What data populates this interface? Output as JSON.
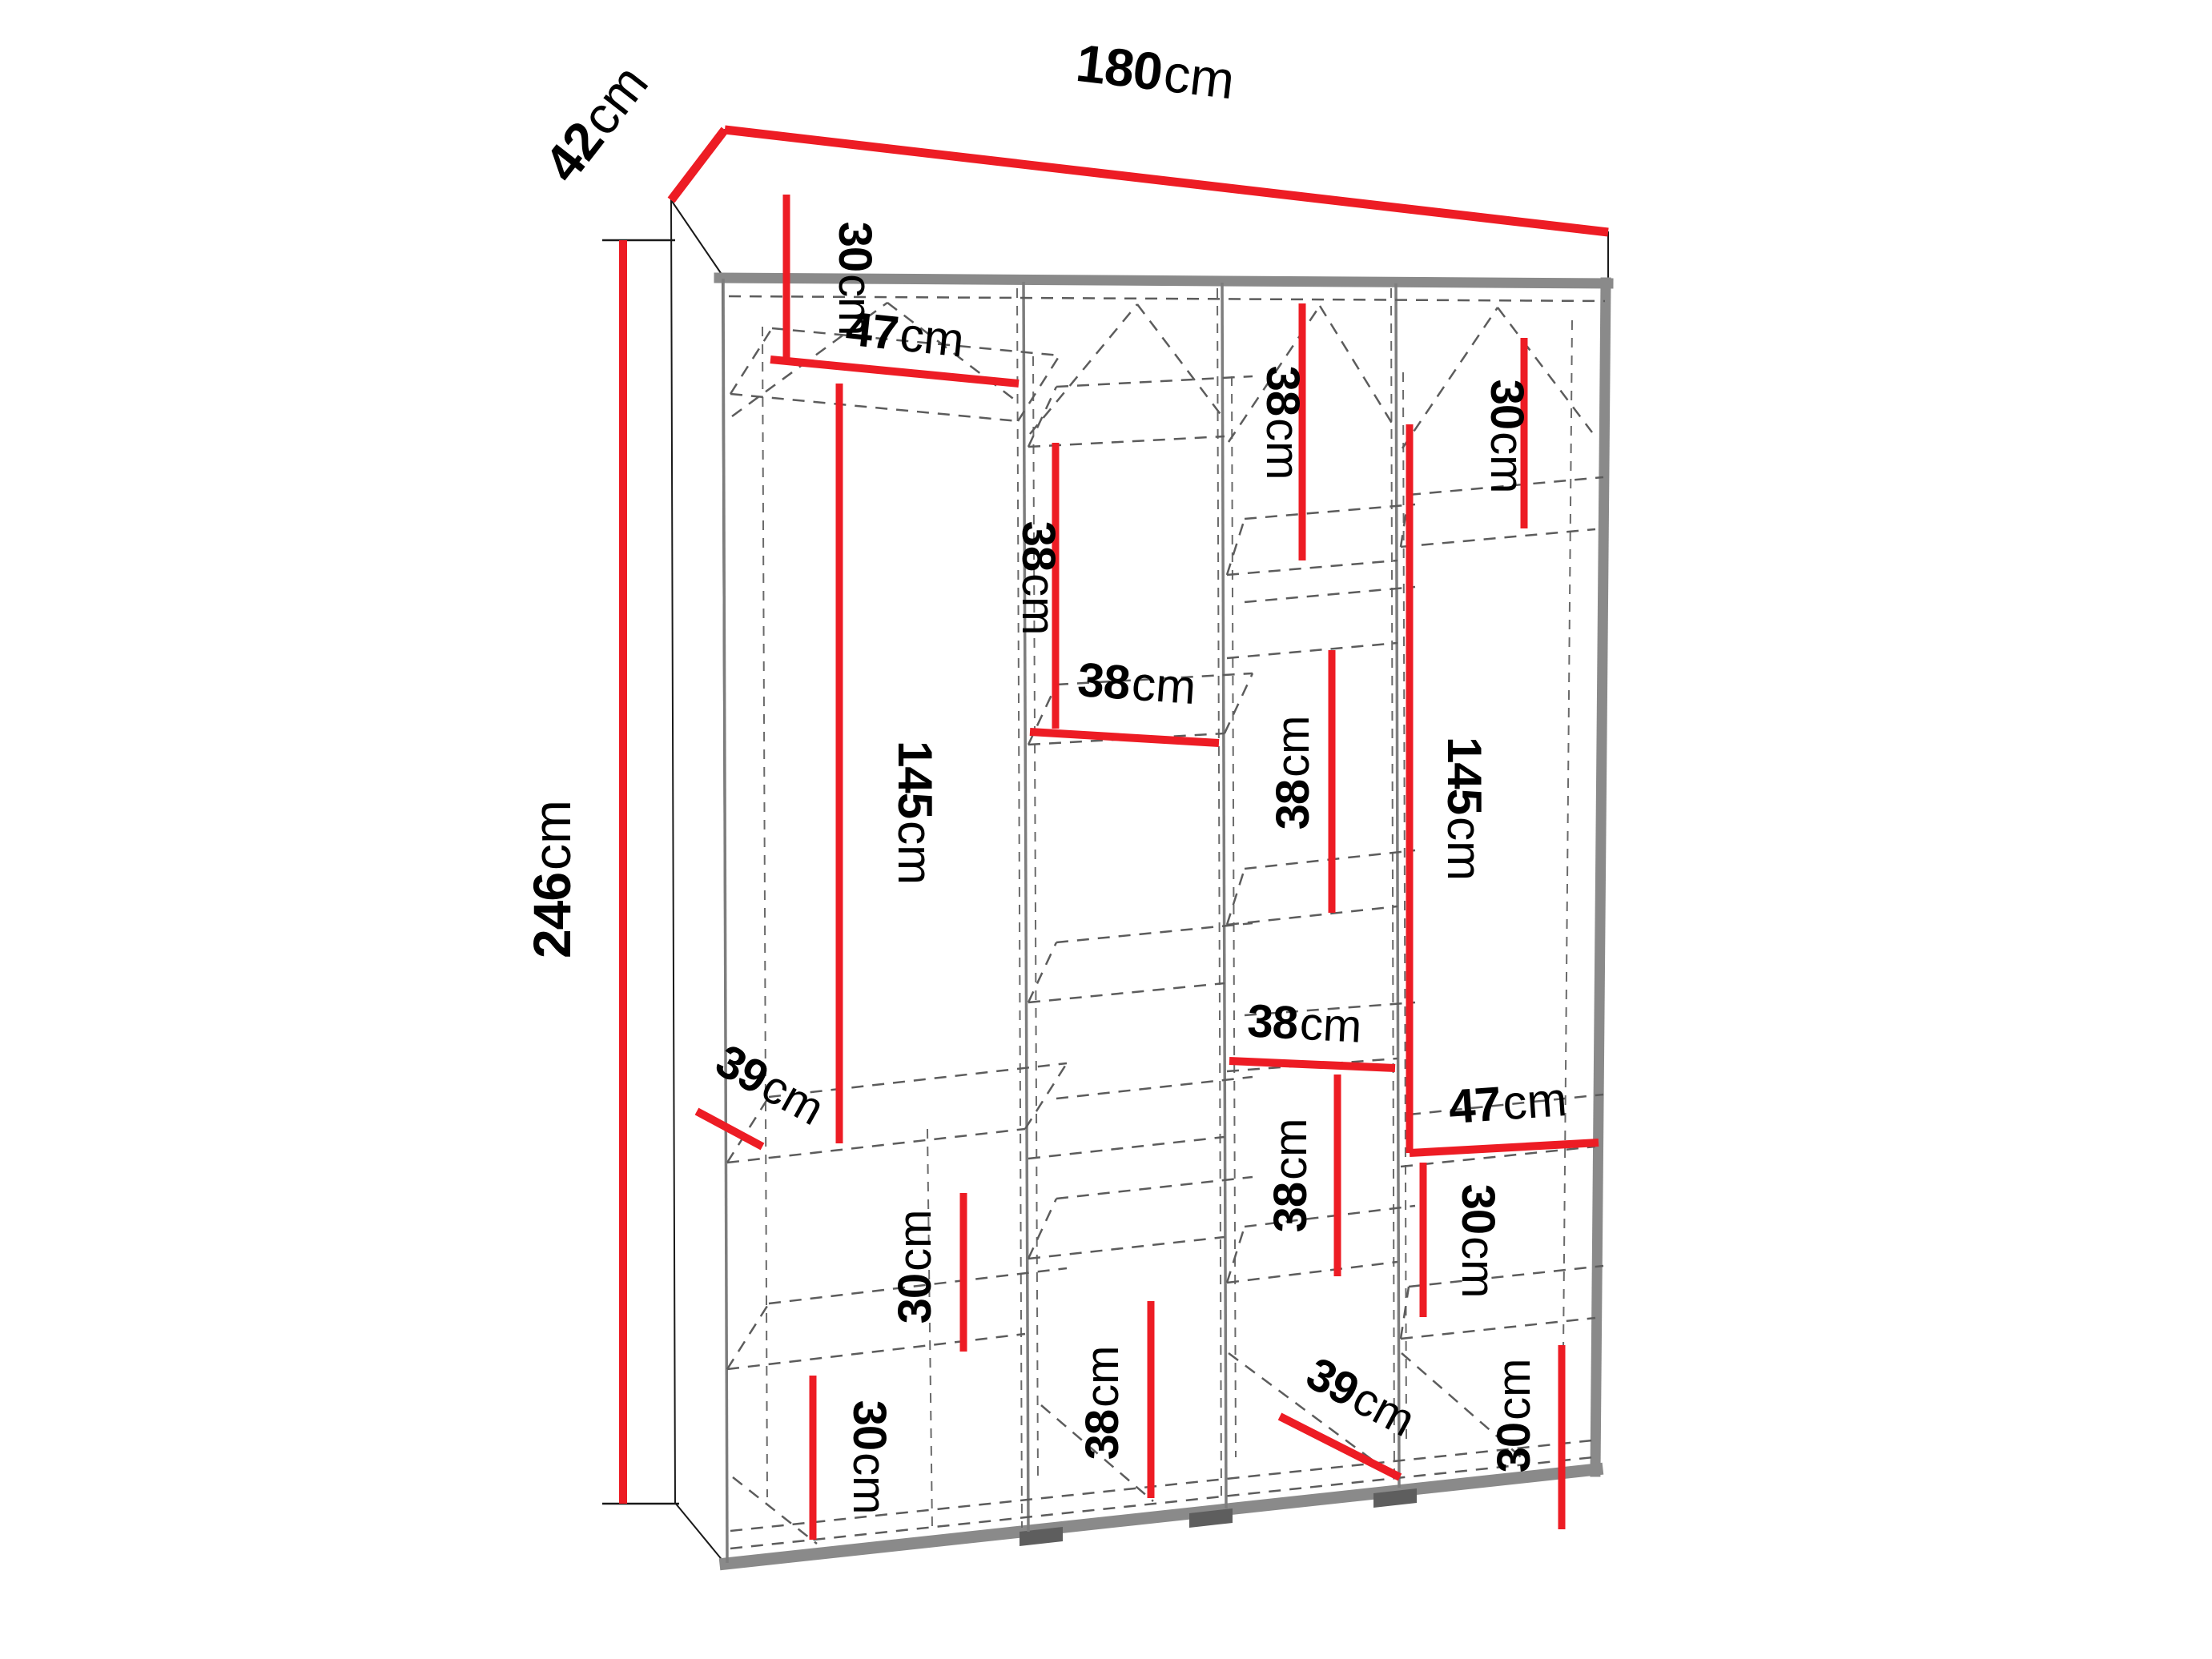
{
  "figure": {
    "kind": "wardrobe-dimension-diagram",
    "unit": "cm",
    "colors": {
      "dimension_line": "#ed1c24",
      "carcass_edge": "#8a8a8a",
      "hidden_line": "#5c5c5c",
      "label_text": "#000000",
      "background": "#ffffff"
    }
  },
  "dimensions": {
    "total_width": {
      "value": "180",
      "unit": "cm"
    },
    "total_depth": {
      "value": "42",
      "unit": "cm"
    },
    "total_height": {
      "value": "246",
      "unit": "cm"
    },
    "col1_top_height": {
      "value": "30",
      "unit": "cm"
    },
    "col1_width": {
      "value": "47",
      "unit": "cm"
    },
    "col1_tall_height": {
      "value": "145",
      "unit": "cm"
    },
    "col1_depth": {
      "value": "39",
      "unit": "cm"
    },
    "col1_mid_height": {
      "value": "30",
      "unit": "cm"
    },
    "col1_low_height": {
      "value": "30",
      "unit": "cm"
    },
    "col2_top_height": {
      "value": "38",
      "unit": "cm"
    },
    "col2_width": {
      "value": "38",
      "unit": "cm"
    },
    "col2_low_height": {
      "value": "38",
      "unit": "cm"
    },
    "col3_top_height": {
      "value": "38",
      "unit": "cm"
    },
    "col3_mid_height": {
      "value": "38",
      "unit": "cm"
    },
    "col3_width": {
      "value": "38",
      "unit": "cm"
    },
    "col3_low_height": {
      "value": "38",
      "unit": "cm"
    },
    "col3_depth": {
      "value": "39",
      "unit": "cm"
    },
    "col4_top_height": {
      "value": "30",
      "unit": "cm"
    },
    "col4_tall_height": {
      "value": "145",
      "unit": "cm"
    },
    "col4_width": {
      "value": "47",
      "unit": "cm"
    },
    "col4_mid_height": {
      "value": "30",
      "unit": "cm"
    },
    "col4_low_height": {
      "value": "30",
      "unit": "cm"
    }
  }
}
